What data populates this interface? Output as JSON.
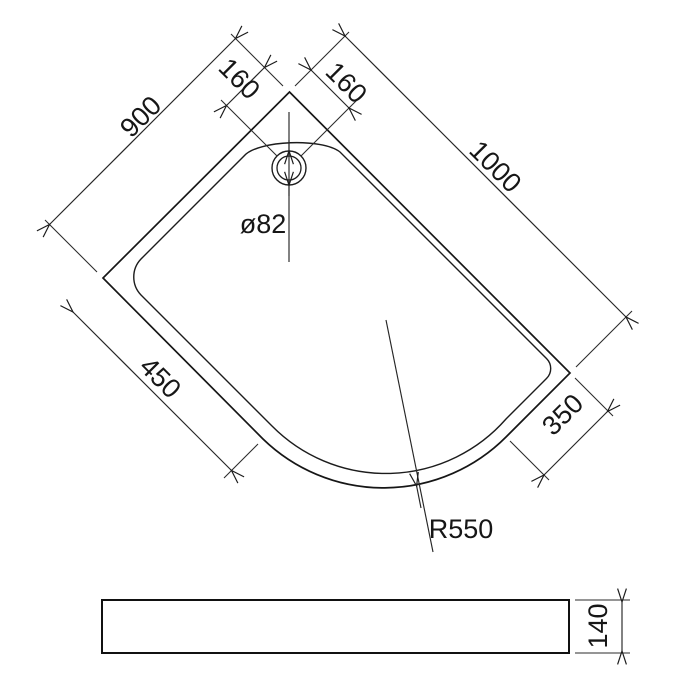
{
  "plan_view": {
    "labels": {
      "side_left": "900",
      "side_right": "1000",
      "drain_offset_left": "160",
      "drain_offset_right": "160",
      "front_edge_left": "450",
      "front_edge_right": "350",
      "drain_diameter": "ø82",
      "front_radius": "R550"
    }
  },
  "side_view": {
    "labels": {
      "height": "140"
    }
  },
  "colors": {
    "line": "#1c1c1c",
    "dimension": "#2b2b2b",
    "background": "#ffffff"
  }
}
